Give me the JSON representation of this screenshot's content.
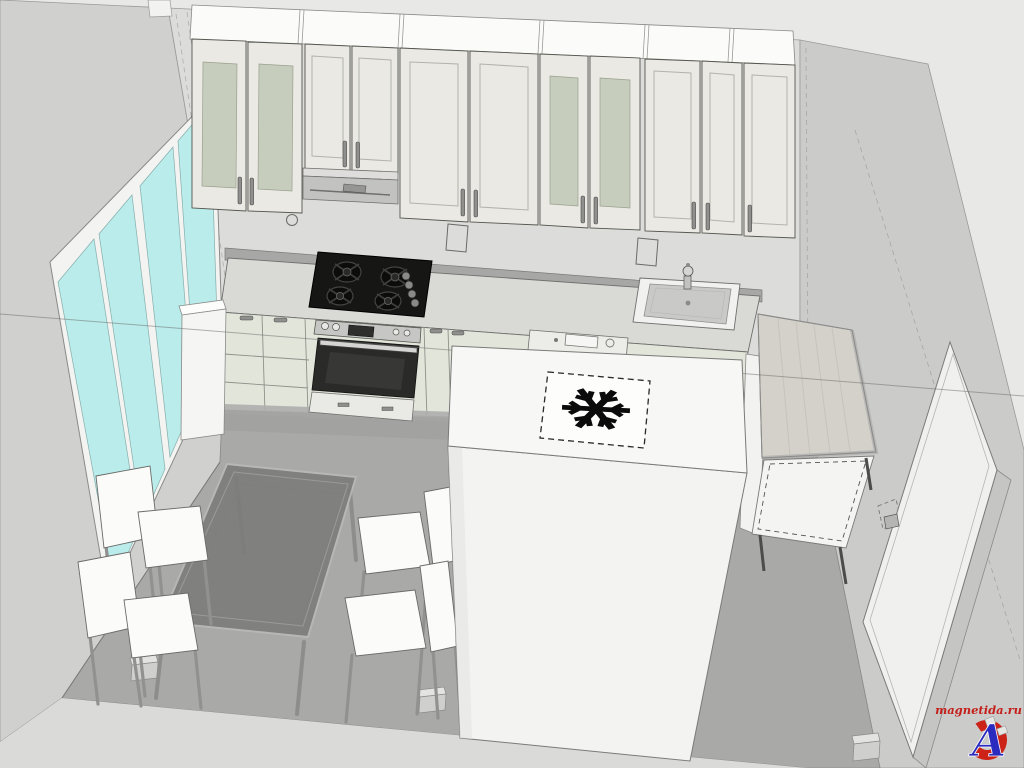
{
  "scene": {
    "description": "3D CAD-style rendering of a kitchen interior viewed from above: wall cabinets, gas hob, oven, sink, refrigerator with freezer snowflake symbol on top, glass dining table with four white chairs, window wall and interior door",
    "render_style": "sketchup-like"
  },
  "watermark": {
    "text": "magnetida.ru",
    "logo_letter": "A"
  },
  "colors": {
    "background": "#e8e8e6",
    "left_wall": "#d0d0ce",
    "back_wall": "#dcdcda",
    "right_wall": "#cbcbc9",
    "floor": "#a9a9a7",
    "front_band": "#dadad8",
    "window_glass": "#b9ecea",
    "window_frame": "#f3f3f1",
    "cabinet_top": "#fbfbf9",
    "cabinet_front": "#ebe9e3",
    "glass_panel": "#c7cdbc",
    "base_cabinet": "#e1e5da",
    "countertop": "#d9d9d6",
    "hob": "#161614",
    "steel": "#c6c6c4",
    "fridge": "#f3f3f1",
    "table_glass": "#7b7b79",
    "chair": "#fbfbf9",
    "wood_top": "#d4d1ca",
    "door": "#f0f0ee",
    "snowflake": "#0b0b0b",
    "section_line": "#6a6a68",
    "watermark_red": "#c41f1a",
    "watermark_blue": "#2b2bc0",
    "watermark_magnet": "#cc2218"
  },
  "objects": {
    "window": {
      "label": "window",
      "panes": 4
    },
    "wall_cabinets": {
      "label": "upper wall cabinets",
      "doors": 11,
      "glass_doors": 4
    },
    "range_hood": {
      "label": "built-in range hood"
    },
    "gas_hob": {
      "label": "gas hob",
      "burners": 4
    },
    "oven": {
      "label": "built-in oven"
    },
    "dishwasher": {
      "label": "dishwasher front panel"
    },
    "sink": {
      "label": "kitchen sink with faucet"
    },
    "refrigerator": {
      "label": "refrigerator",
      "top_symbol": "freezer-snowflake"
    },
    "side_unit": {
      "label": "base cabinet with wooden top"
    },
    "dining_table": {
      "label": "glass dining table"
    },
    "chairs": {
      "label": "white dining chair",
      "count": 4
    },
    "door": {
      "label": "interior door"
    },
    "radiator": {
      "label": "white wall unit below window"
    },
    "wall_sockets": {
      "label": "wall socket",
      "count": 2
    }
  }
}
